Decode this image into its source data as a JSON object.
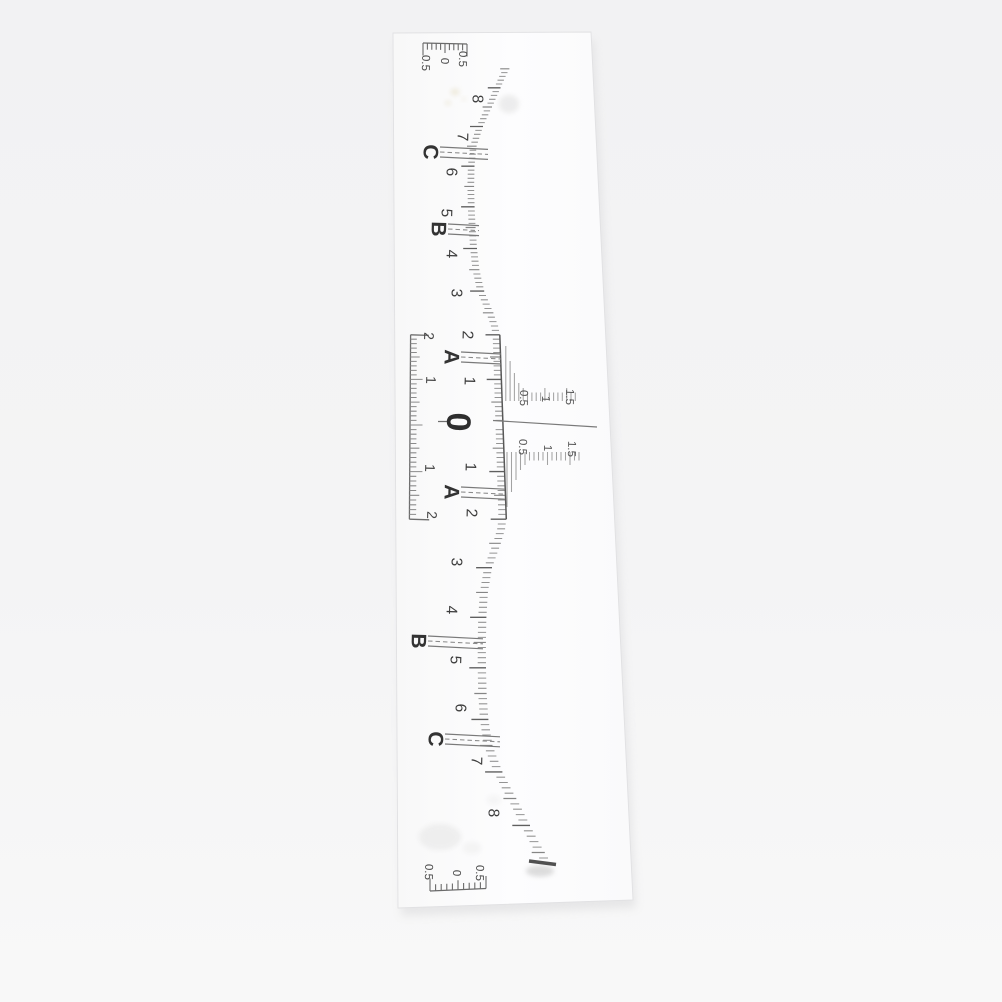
{
  "scene": {
    "description": "product photo of transparent eyebrow mapping ruler sticker",
    "background_top": "#f2f2f3",
    "background_bottom": "#f8f8f8",
    "strip_fill": "#fcfcfd",
    "strip_edge": "#e1e1e3",
    "shadow_color": "#d2d2d4",
    "ink_dark": "#3d3d3d",
    "ink_mid": "#5f5f5f",
    "ink_light": "#949494",
    "strip_corners": [
      [
        393,
        33
      ],
      [
        591,
        32
      ],
      [
        633,
        900
      ],
      [
        398,
        908
      ]
    ]
  },
  "geometry": {
    "cx": 503,
    "cy": 425,
    "a": 46.1,
    "b": 0.4935,
    "tilt": 0.035,
    "k": 0.00045,
    "curve": [
      [
        0,
        0
      ],
      [
        2,
        0
      ],
      [
        2.2,
        -1.5
      ],
      [
        2.5,
        -6
      ],
      [
        3,
        -15
      ],
      [
        3.5,
        -19.5
      ],
      [
        4,
        -21.5
      ],
      [
        4.5,
        -22.5
      ],
      [
        5,
        -23
      ],
      [
        5.5,
        -23
      ],
      [
        6,
        -22
      ],
      [
        6.5,
        -19
      ],
      [
        7,
        -11
      ],
      [
        7.3,
        -4.5
      ],
      [
        7.6,
        2.5
      ],
      [
        8,
        11
      ],
      [
        8.3,
        17.5
      ],
      [
        8.6,
        25
      ],
      [
        8.8,
        29
      ]
    ],
    "tick": {
      "i_min": -85,
      "i_max": 86,
      "minor": 7.5,
      "half": 11,
      "integer": 15
    },
    "box": {
      "u": 93,
      "bracket_len": 19,
      "minor": 6.5,
      "half": 9.5,
      "integer": 12.5
    },
    "comb_top": {
      "x0": 501.4,
      "dx": 4.35,
      "y0": 401,
      "dir": -1,
      "n": 17
    },
    "comb_bottom": {
      "x0": 502.5,
      "dx": 4.5,
      "y0": 452,
      "dir": 1,
      "n": 17
    },
    "comb_heights": [
      55,
      40,
      28,
      18
    ],
    "comb_short": 8.5,
    "comb_label_tick": 13,
    "center_line": {
      "x1": 493,
      "y1": 420.5,
      "x2": 597,
      "y2": 427
    },
    "end_scale_top": {
      "x0": 423,
      "y0": 43,
      "dx": 4.4,
      "dy": 0.1,
      "n": 11,
      "tick_dir": 1
    },
    "end_scale_bottom": {
      "x0": 430,
      "y0": 891,
      "dx": 5.6,
      "dy": -0.25,
      "n": 11,
      "tick_dir": -1
    },
    "end_mark": {
      "x1": 529,
      "y1": 861,
      "x2": 556,
      "y2": 864.5,
      "width": 3.5,
      "color": "#3f3f3f"
    }
  },
  "labels": {
    "center": {
      "text": "0",
      "x": 459,
      "y": 422
    },
    "main_top": [
      {
        "text": "1",
        "x": 470,
        "y": 381
      },
      {
        "text": "2",
        "x": 468,
        "y": 335
      },
      {
        "text": "3",
        "x": 457,
        "y": 293
      },
      {
        "text": "4",
        "x": 452,
        "y": 254
      },
      {
        "text": "5",
        "x": 447,
        "y": 213
      },
      {
        "text": "6",
        "x": 452,
        "y": 172
      },
      {
        "text": "7",
        "x": 463,
        "y": 137
      },
      {
        "text": "8",
        "x": 478,
        "y": 99
      }
    ],
    "main_bottom": [
      {
        "text": "1",
        "x": 471,
        "y": 467
      },
      {
        "text": "2",
        "x": 472,
        "y": 513
      },
      {
        "text": "3",
        "x": 457,
        "y": 562
      },
      {
        "text": "4",
        "x": 452,
        "y": 610
      },
      {
        "text": "5",
        "x": 456,
        "y": 660
      },
      {
        "text": "6",
        "x": 461,
        "y": 708
      },
      {
        "text": "7",
        "x": 477,
        "y": 761
      },
      {
        "text": "8",
        "x": 494,
        "y": 813
      }
    ],
    "box": [
      {
        "text": "2",
        "x": 429,
        "y": 336
      },
      {
        "text": "1",
        "x": 431,
        "y": 380
      },
      {
        "text": "1",
        "x": 430,
        "y": 468
      },
      {
        "text": "2",
        "x": 432,
        "y": 515
      }
    ],
    "comb_top": [
      {
        "text": "0.5",
        "x": 524,
        "y": 398
      },
      {
        "text": "1",
        "x": 546,
        "y": 399
      },
      {
        "text": "1.5",
        "x": 570,
        "y": 397
      }
    ],
    "comb_bottom": [
      {
        "text": "0.5",
        "x": 523,
        "y": 447
      },
      {
        "text": "1",
        "x": 548,
        "y": 448
      },
      {
        "text": "1.5",
        "x": 572,
        "y": 449
      }
    ],
    "end_top": [
      {
        "text": "0.5",
        "x": 426,
        "y": 63
      },
      {
        "text": "0",
        "x": 445,
        "y": 61
      },
      {
        "text": "0.5",
        "x": 463,
        "y": 59
      }
    ],
    "end_bottom": [
      {
        "text": "0.5",
        "x": 429,
        "y": 872
      },
      {
        "text": "0",
        "x": 457,
        "y": 873
      },
      {
        "text": "0.5",
        "x": 480,
        "y": 873
      }
    ]
  },
  "markers": [
    {
      "letter": "C",
      "t": -6.5,
      "x": 431,
      "y": 152,
      "x2": 488
    },
    {
      "letter": "B",
      "t": -4.5,
      "x": 439,
      "y": 229,
      "x2": 479
    },
    {
      "letter": "A",
      "t": -1.5,
      "x": 452,
      "y": 357,
      "x2": 501
    },
    {
      "letter": "A",
      "t": 1.5,
      "x": 452,
      "y": 492,
      "x2": 505
    },
    {
      "letter": "B",
      "t": 4.5,
      "x": 419,
      "y": 641,
      "x2": 483
    },
    {
      "letter": "C",
      "t": 6.5,
      "x": 436,
      "y": 739,
      "x2": 500
    }
  ],
  "stains": [
    {
      "x": 455,
      "y": 92,
      "rx": 4.5,
      "ry": 3.5,
      "color": "#e6dfc6",
      "opacity": 0.55
    },
    {
      "x": 448,
      "y": 103,
      "rx": 3,
      "ry": 2.4,
      "color": "#e6dfc6",
      "opacity": 0.5
    },
    {
      "x": 464,
      "y": 99,
      "rx": 2.2,
      "ry": 1.8,
      "color": "#eae3cf",
      "opacity": 0.45
    },
    {
      "x": 509,
      "y": 104,
      "rx": 10,
      "ry": 9,
      "color": "#e4e4e4",
      "opacity": 0.65
    },
    {
      "x": 440,
      "y": 837,
      "rx": 21,
      "ry": 13,
      "color": "#e9e9e9",
      "opacity": 0.7
    },
    {
      "x": 472,
      "y": 848,
      "rx": 9,
      "ry": 6,
      "color": "#ececec",
      "opacity": 0.5
    },
    {
      "x": 494,
      "y": 800,
      "rx": 7,
      "ry": 5,
      "color": "#eeeeee",
      "opacity": 0.5
    },
    {
      "x": 540,
      "y": 871,
      "rx": 14,
      "ry": 5.5,
      "color": "#c6c6c6",
      "opacity": 0.6
    }
  ]
}
